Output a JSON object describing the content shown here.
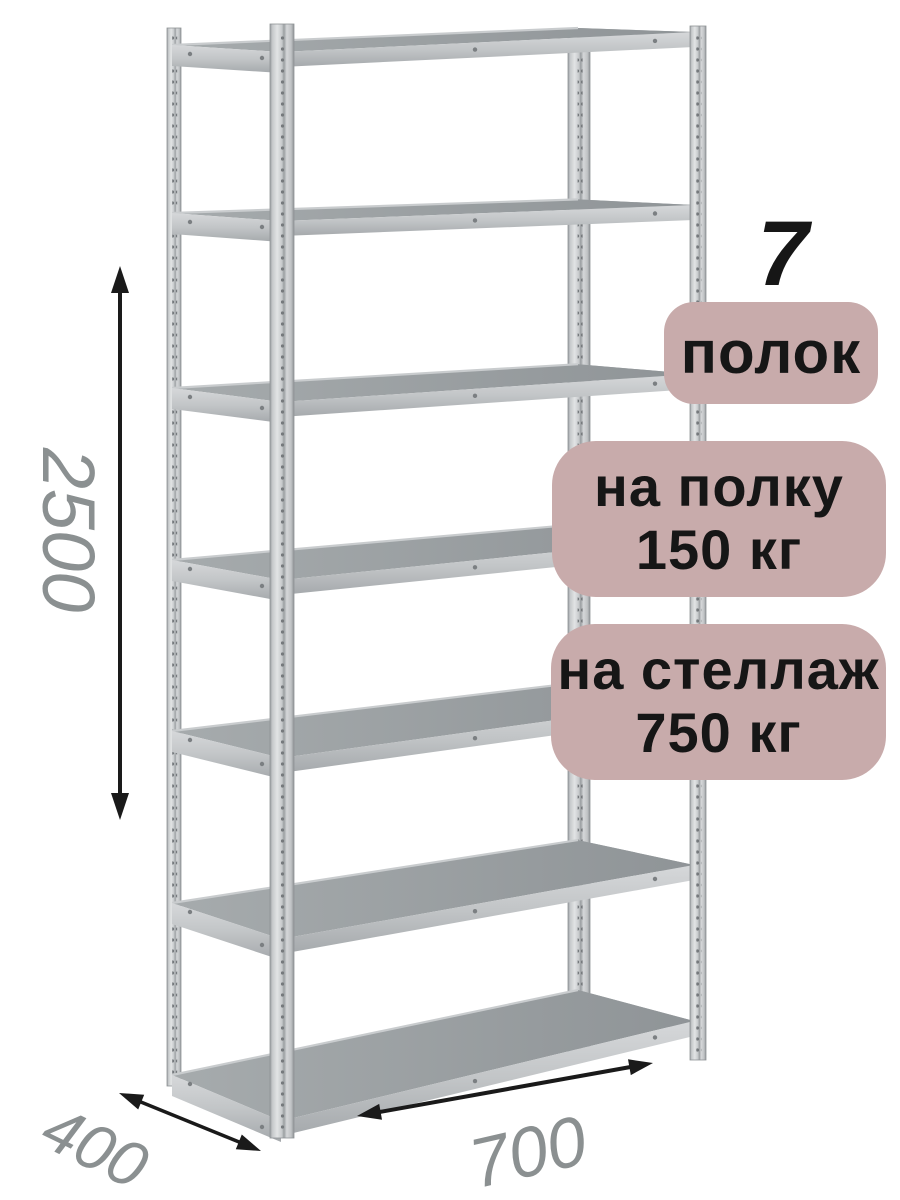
{
  "product": {
    "shelf_count": 7,
    "badge_shelf_count_number": "7",
    "badge_shelf_count_label": "полок",
    "badge_per_shelf_line1": "на полку",
    "badge_per_shelf_line2": "150 кг",
    "badge_per_rack_line1": "на стеллаж",
    "badge_per_rack_line2": "750 кг"
  },
  "dimensions": {
    "height_mm": "2500",
    "depth_mm": "400",
    "width_mm": "700"
  },
  "colors": {
    "background": "#ffffff",
    "badge_bg": "#c8abab",
    "ink": "#161616",
    "dimension_label": "#8b9091",
    "arrow": "#1a1a1a",
    "metal_light": "#d6d8da",
    "metal_mid": "#aeb2b5",
    "metal_dark": "#8f9397",
    "shelf_surface": "#9aa0a3"
  }
}
